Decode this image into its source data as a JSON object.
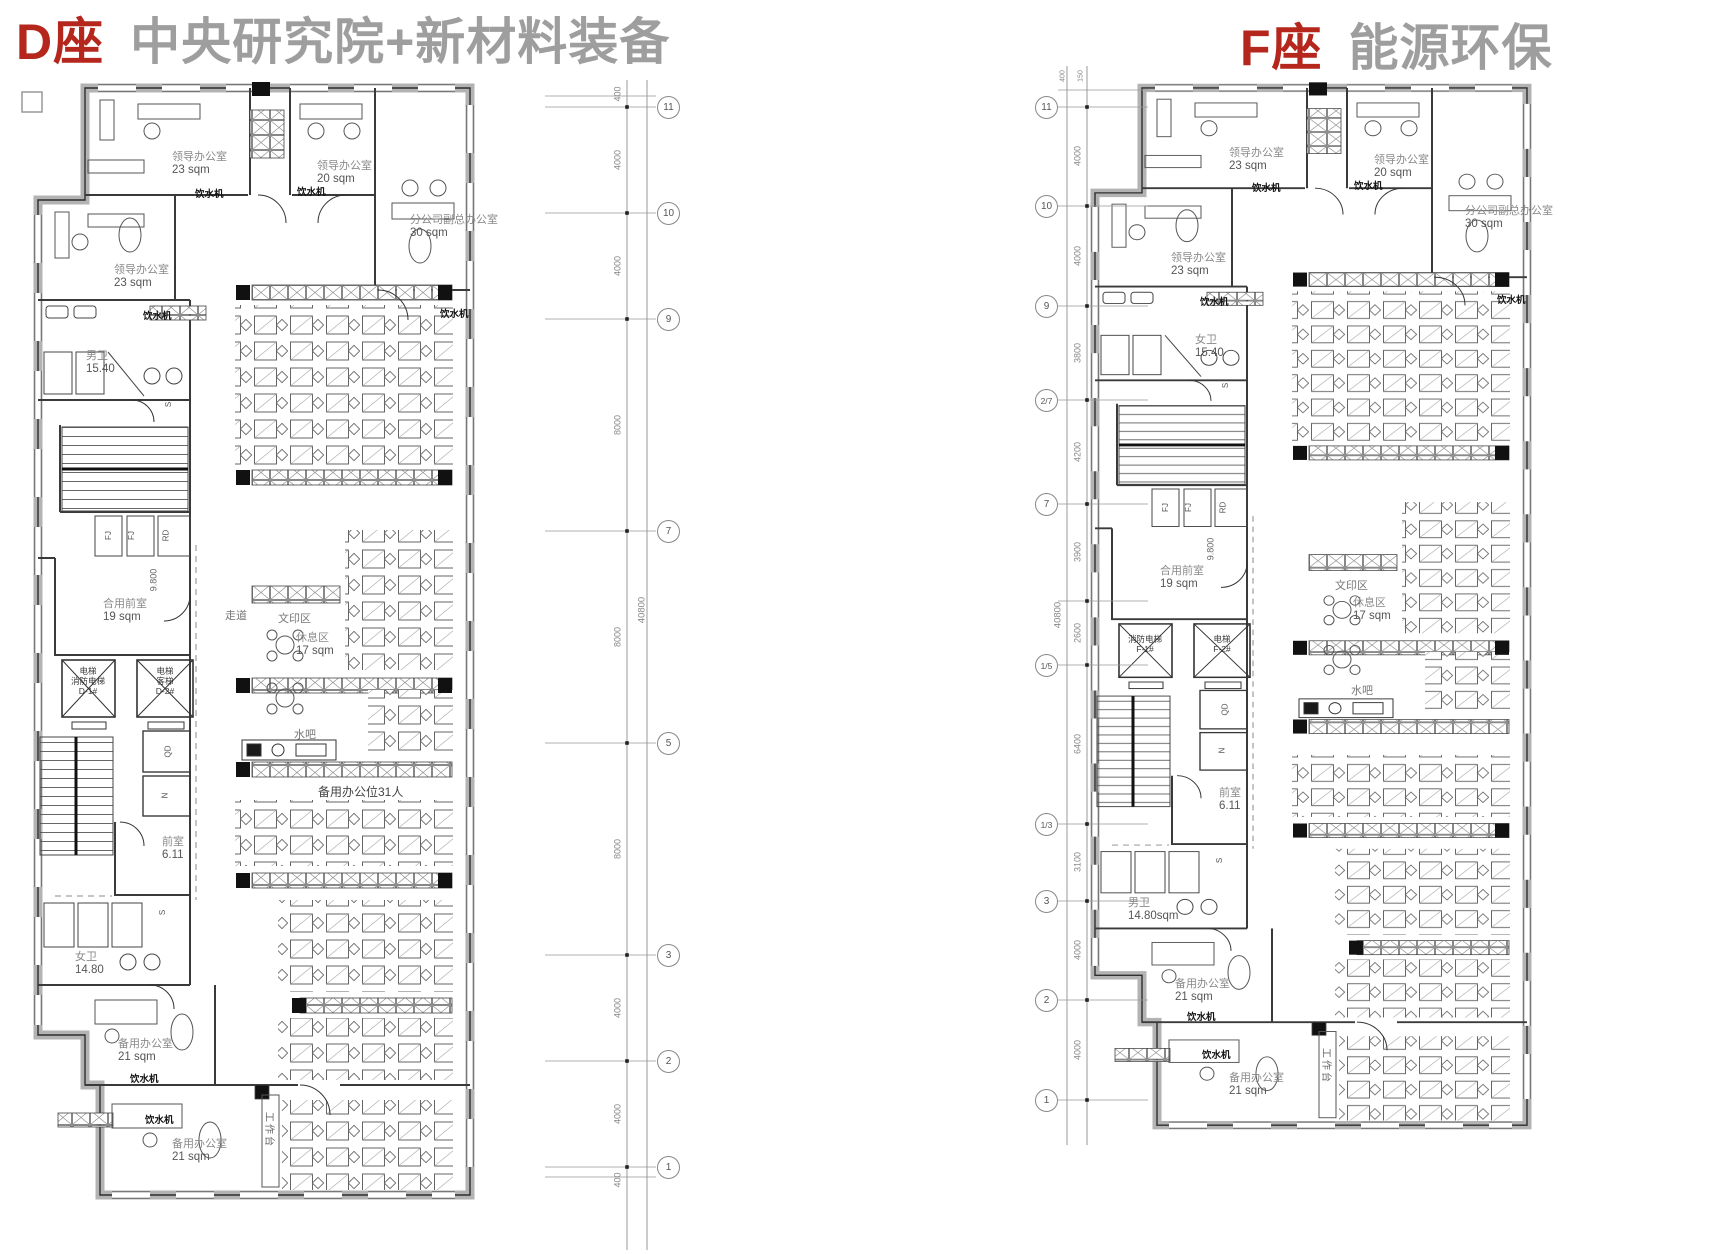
{
  "plan_d": {
    "title_prefix": "D座",
    "title_suffix": "中央研究院+新材料装备",
    "rooms": {
      "office_tl": {
        "name": "领导办公室",
        "area": "23 sqm"
      },
      "office_tc": {
        "name": "领导办公室",
        "area": "20 sqm"
      },
      "office_vp": {
        "name": "分公司副总办公室",
        "area": "30 sqm"
      },
      "office_l": {
        "name": "领导办公室",
        "area": "23 sqm"
      },
      "wc_top": {
        "name": "男卫",
        "area": "15.40"
      },
      "lobby": {
        "name": "合用前室",
        "area": "19 sqm"
      },
      "rest": {
        "name": "休息区",
        "area": "17 sqm"
      },
      "ante": {
        "name": "前室",
        "area": "6.11"
      },
      "wc_bottom": {
        "name": "女卫",
        "area": "14.80"
      },
      "spare_office_1": {
        "name": "备用办公室",
        "area": "21 sqm"
      },
      "spare_office_2": {
        "name": "备用办公室",
        "area": "21 sqm"
      }
    },
    "zones": {
      "print": "文印区",
      "water_bar": "水吧",
      "corridor": "走道",
      "spare_seats": "备用办公位31人",
      "workbench": "工作台"
    },
    "equipment": {
      "water_dispenser": "饮水机",
      "elevation": "9.800"
    },
    "elevators": {
      "e1_l1": "电梯",
      "e1_l2": "消防电梯",
      "e1_l3": "D-1#",
      "e2_l1": "电梯",
      "e2_l2": "客梯",
      "e2_l3": "D-2#"
    },
    "tags": {
      "s": "S",
      "fj": "FJ",
      "rd": "RD",
      "qd": "QD",
      "n": "N"
    },
    "grid": {
      "total": "40800",
      "bubbles": [
        "11",
        "10",
        "9",
        "7",
        "5",
        "3",
        "2",
        "1"
      ],
      "dims": [
        "400",
        "4000",
        "4000",
        "8000",
        "8000",
        "8000",
        "4000",
        "4000",
        "400"
      ]
    }
  },
  "plan_f": {
    "title_prefix": "F座",
    "title_suffix": "能源环保",
    "rooms": {
      "office_tl": {
        "name": "领导办公室",
        "area": "23 sqm"
      },
      "office_tc": {
        "name": "领导办公室",
        "area": "20 sqm"
      },
      "office_vp": {
        "name": "分公司副总办公室",
        "area": "30 sqm"
      },
      "office_l": {
        "name": "领导办公室",
        "area": "23 sqm"
      },
      "wc_top": {
        "name": "女卫",
        "area": "15.40"
      },
      "lobby": {
        "name": "合用前室",
        "area": "19 sqm"
      },
      "rest": {
        "name": "休息区",
        "area": "17 sqm"
      },
      "ante": {
        "name": "前室",
        "area": "6.11"
      },
      "wc_bottom": {
        "name": "男卫",
        "area": "14.80sqm"
      },
      "spare_office_1": {
        "name": "备用办公室",
        "area": "21 sqm"
      },
      "spare_office_2": {
        "name": "备用办公室",
        "area": "21 sqm"
      }
    },
    "zones": {
      "print": "文印区",
      "water_bar": "水吧",
      "workbench": "工作台"
    },
    "equipment": {
      "water_dispenser": "饮水机",
      "elevation": "9.800"
    },
    "elevators": {
      "e1_l1": "消防电梯",
      "e1_l2": "F-1#",
      "e2_l1": "电梯",
      "e2_l2": "F-2#"
    },
    "tags": {
      "s": "S",
      "fj": "FJ",
      "rd": "RD",
      "qd": "QD",
      "n": "N"
    },
    "grid": {
      "total": "40800",
      "top_dims": [
        "400",
        "150"
      ],
      "bubbles": [
        "11",
        "10",
        "9",
        "2/7",
        "7",
        "1/5",
        "1/3",
        "3",
        "2",
        "1"
      ],
      "dims": [
        "4000",
        "4000",
        "3800",
        "4200",
        "3900",
        "2600",
        "6400",
        "3100",
        "4000",
        "4000"
      ]
    }
  }
}
